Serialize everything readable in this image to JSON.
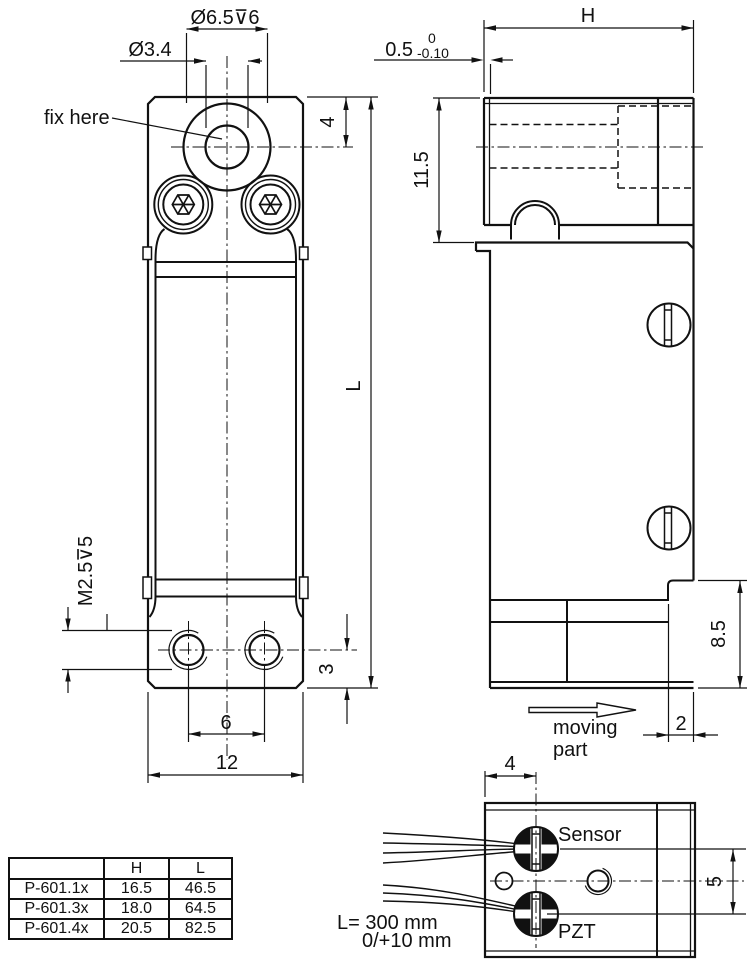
{
  "front_view": {
    "counterbore": "Ø6.5⊽6",
    "through_hole": "Ø3.4",
    "fix_here": "fix here",
    "top_offset": "4",
    "length": "L",
    "thread": "M2.5⊽5",
    "edge_dist": "3",
    "hole_spacing": "6",
    "width": "12"
  },
  "side_view": {
    "height": "H",
    "tol_value": "0.5",
    "tol_upper": "0",
    "tol_lower": "-0.10",
    "top_section": "11.5",
    "moving_height": "8.5",
    "step": "2",
    "moving_line1": "moving",
    "moving_line2": "part"
  },
  "detail_view": {
    "sensor": "Sensor",
    "pzt": "PZT",
    "wire_pos": "4",
    "wire_spacing": "5",
    "cable_len1": "L= 300 mm",
    "cable_len2": "0/+10 mm"
  },
  "table": {
    "headers": [
      "",
      "H",
      "L"
    ],
    "rows": [
      {
        "model": "P-601.1x",
        "h": "16.5",
        "l": "46.5"
      },
      {
        "model": "P-601.3x",
        "h": "18.0",
        "l": "64.5"
      },
      {
        "model": "P-601.4x",
        "h": "20.5",
        "l": "82.5"
      }
    ]
  }
}
